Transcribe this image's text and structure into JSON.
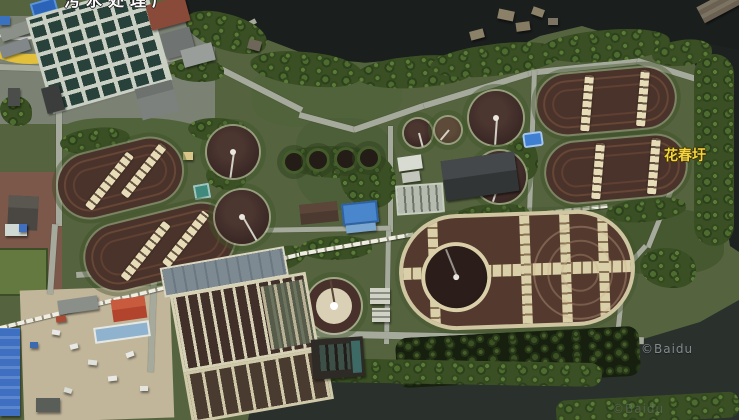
{
  "map": {
    "view": "satellite",
    "labels": {
      "top_place": "污水处理厂",
      "right_place": "花春圩"
    },
    "watermark": {
      "primary": "©Baidu",
      "secondary": "©Baidu"
    },
    "colors": {
      "water_dark": "#1a1e1c",
      "river": "#2c322e",
      "vegetation": "#3a4f24",
      "road_gray": "#a6aa9c",
      "tank_brown": "#4a332b",
      "walkway_cream": "#e6dcb8",
      "place_label_yellow": "#f4d441",
      "place_label_white": "#ffffff",
      "highway_overlay_yellow": "#e2c03c",
      "blue_roof": "#4a86cc"
    }
  }
}
